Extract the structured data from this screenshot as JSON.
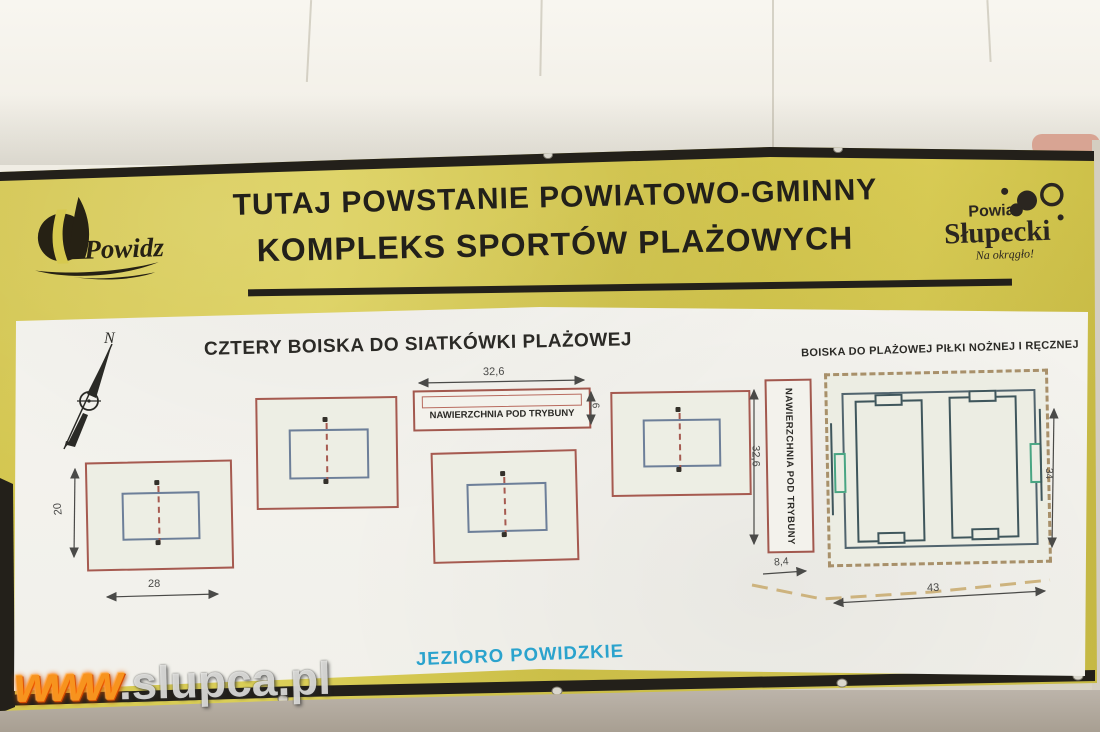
{
  "banner": {
    "title_line1": "TUTAJ POWSTANIE POWIATOWO-GMINNY",
    "title_line2": "KOMPLEKS SPORTÓW PLAŻOWYCH"
  },
  "logos": {
    "powidz": {
      "name": "Powidz"
    },
    "powiat": {
      "line1": "Powiat",
      "line2": "Słupecki",
      "tagline": "Na okrągło!"
    }
  },
  "plan": {
    "compass": "N",
    "heading_volleyball": "CZTERY BOISKA DO SIATKÓWKI PLAŻOWEJ",
    "heading_fields": "BOISKA DO PLAŻOWEJ PIŁKI NOŻNEJ I RĘCZNEJ",
    "tribune_top_label": "NAWIERZCHNIA POD TRYBUNY",
    "tribune_side_label": "NAWIERZCHNIA POD TRYBUNY",
    "lake_label": "JEZIORO POWIDZKIE",
    "dims": {
      "tribune_top_width": "32,6",
      "tribune_top_depth": "6",
      "court_height": "20",
      "court_width": "28",
      "tribune_side_length": "32,6",
      "tribune_side_width": "8,4",
      "fields_height": "34",
      "path_length": "43"
    }
  },
  "watermark": {
    "prefix": "www",
    "suffix": ".slupca.pl"
  },
  "colors": {
    "banner_yellow": "#d6c94f",
    "banner_black": "#23201a",
    "plan_red": "#a65a50",
    "court_blue": "#6d7f99",
    "field_teal": "#3f565c",
    "goal_green": "#49a583",
    "sand_tan": "#a8906a",
    "lake_blue": "#2ba3cd",
    "watermark_orange": "#f7931e"
  }
}
